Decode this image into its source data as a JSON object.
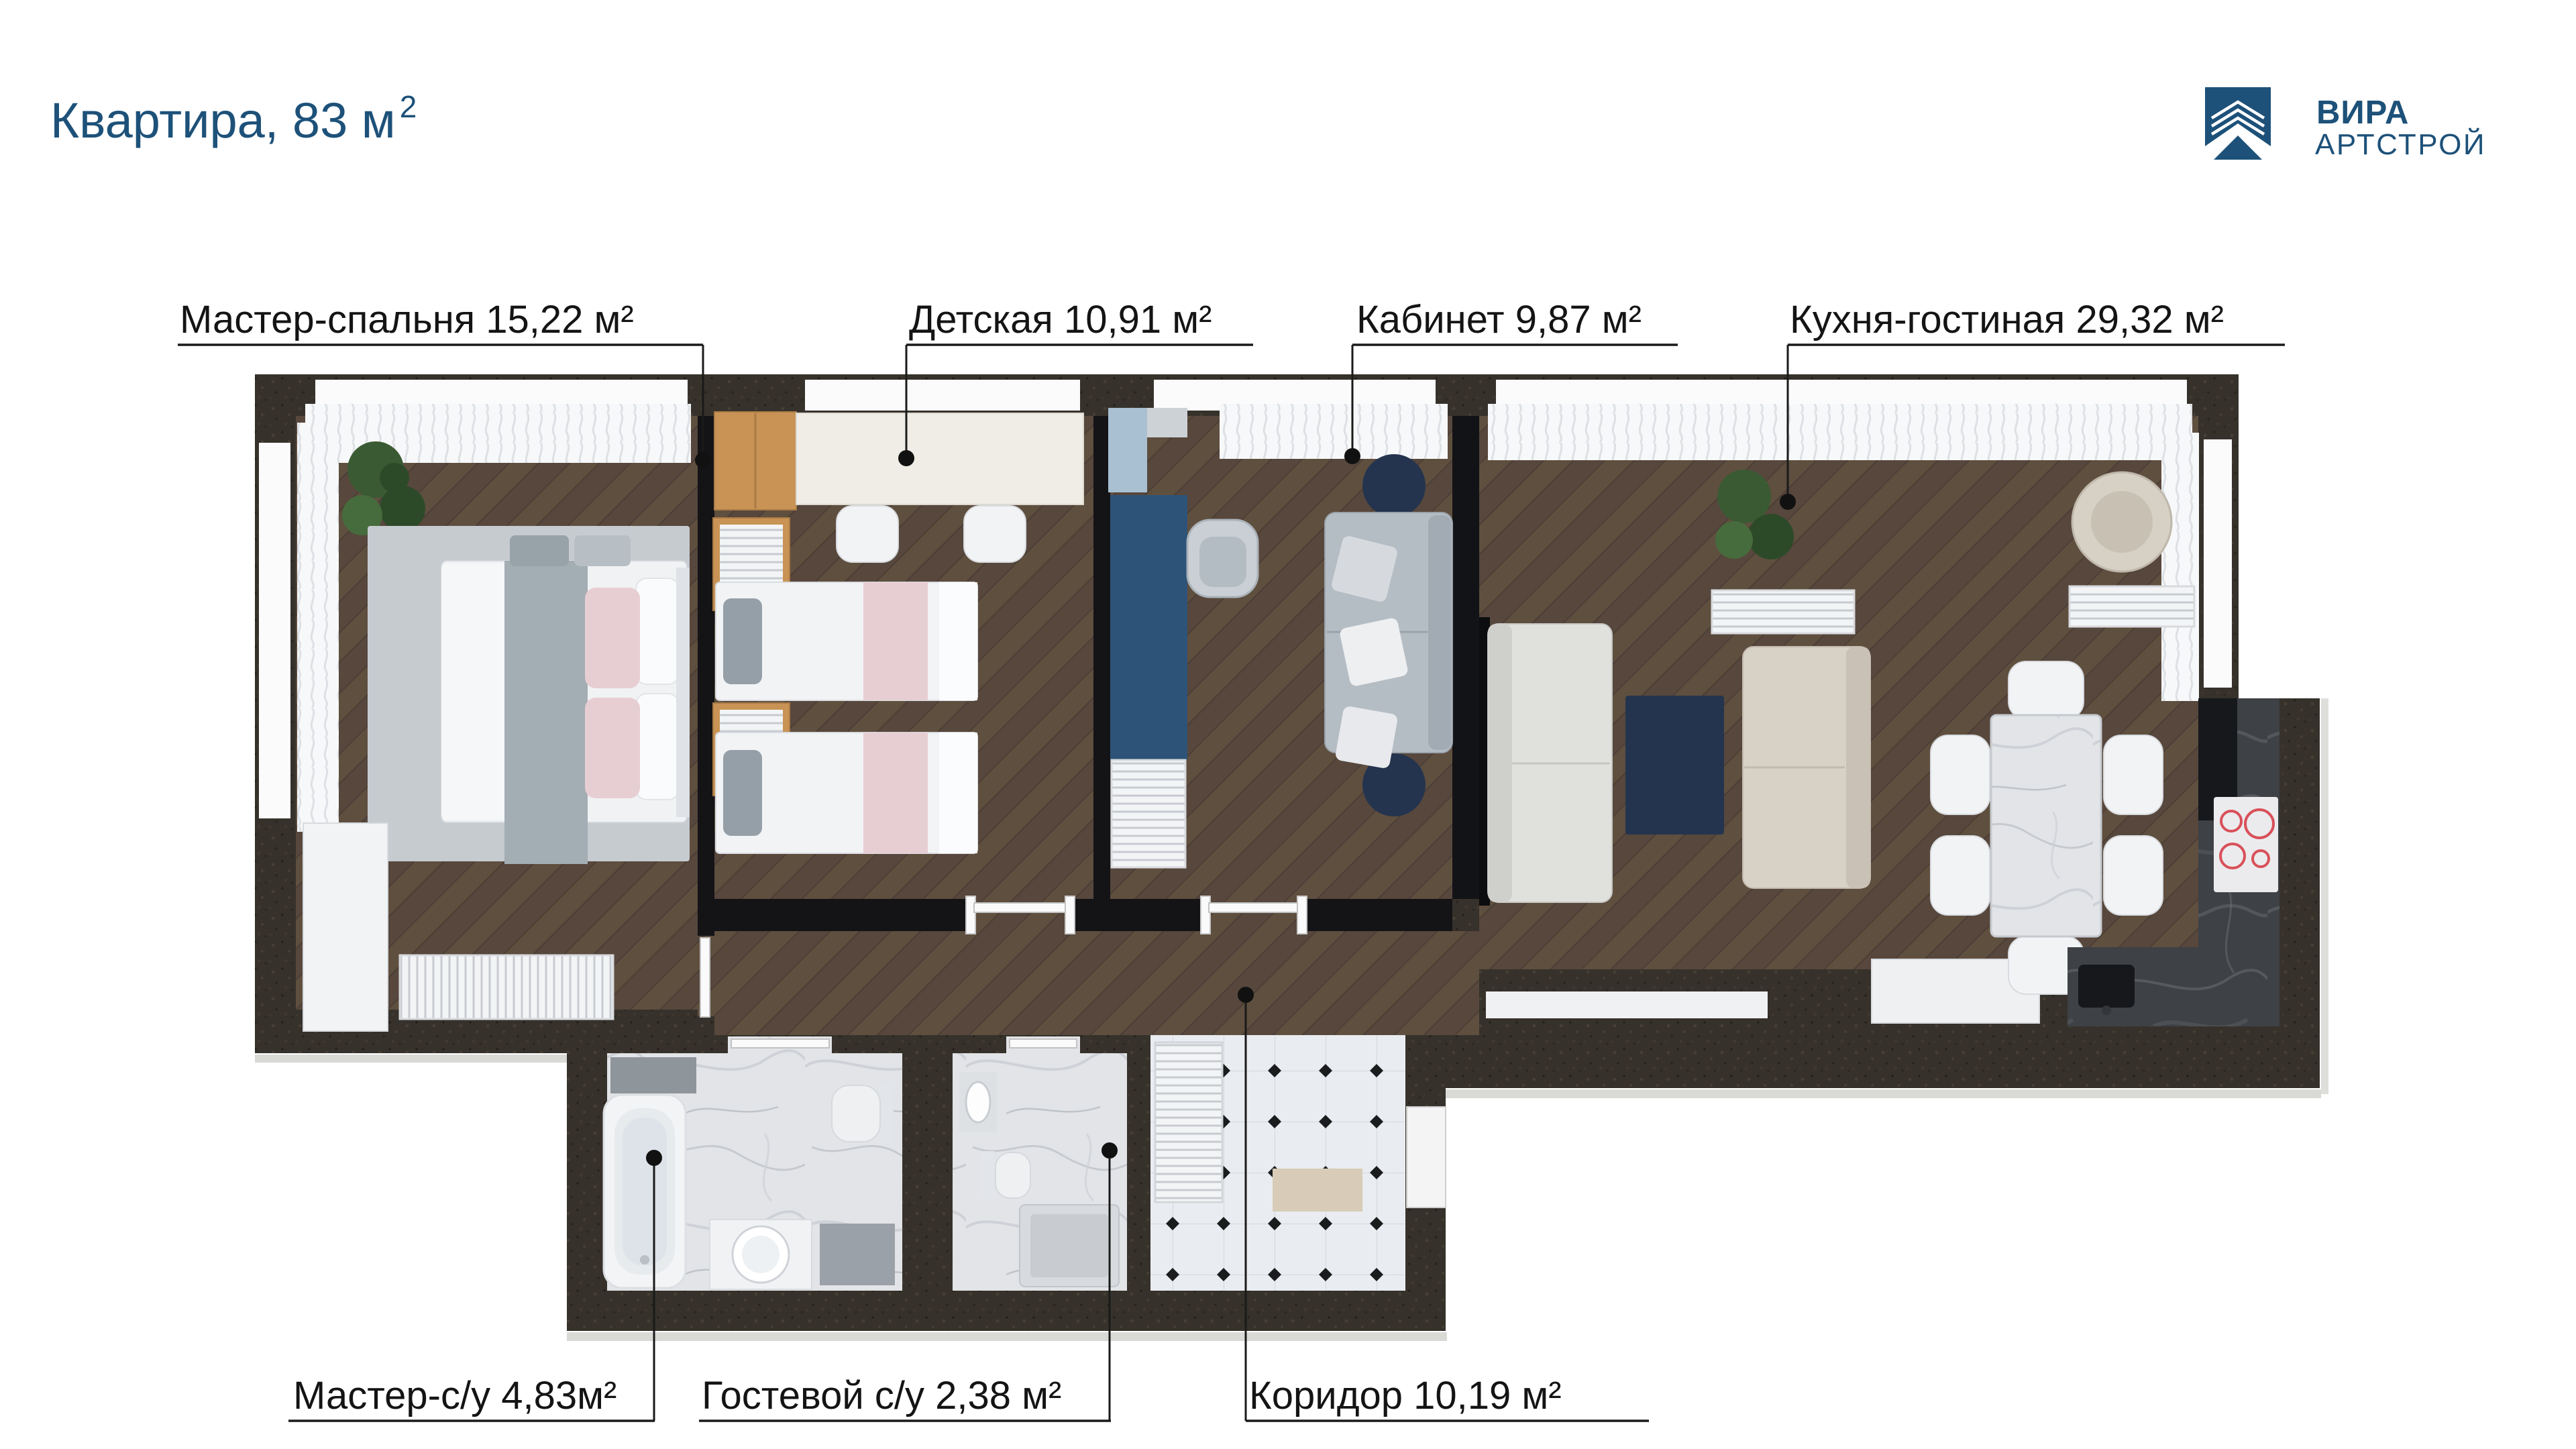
{
  "title": {
    "text": "Квартира, 83 м",
    "sup": "2"
  },
  "logo": {
    "line1": "ВИРА",
    "line2": "АРТСТРОЙ"
  },
  "rooms": [
    {
      "id": "master-bedroom",
      "label": "Мастер-спальня 15,22 м²"
    },
    {
      "id": "kids-room",
      "label": "Детская 10,91 м²"
    },
    {
      "id": "office",
      "label": "Кабинет 9,87 м²"
    },
    {
      "id": "kitchen-living",
      "label": "Кухня-гостиная 29,32 м²"
    },
    {
      "id": "master-bathroom",
      "label": "Мастер-с/у 4,83м²"
    },
    {
      "id": "guest-bathroom",
      "label": "Гостевой с/у 2,38 м²"
    },
    {
      "id": "corridor",
      "label": "Коридор 10,19 м²"
    }
  ],
  "colors": {
    "brand": "#1d5179",
    "label_text": "#141414",
    "wall_outer": "#36322b",
    "wall_inner": "#141417",
    "floor_wood": "#57473d",
    "floor_tile": "#e9ecf0",
    "marble_light": "#e2e4e7",
    "marble_dark": "#3e4145",
    "navy": "#24344e",
    "cabinet_blue": "#2e5378",
    "oak": "#c89355",
    "curtain": "#f7f8f9",
    "hob_ring": "#d9505a"
  }
}
